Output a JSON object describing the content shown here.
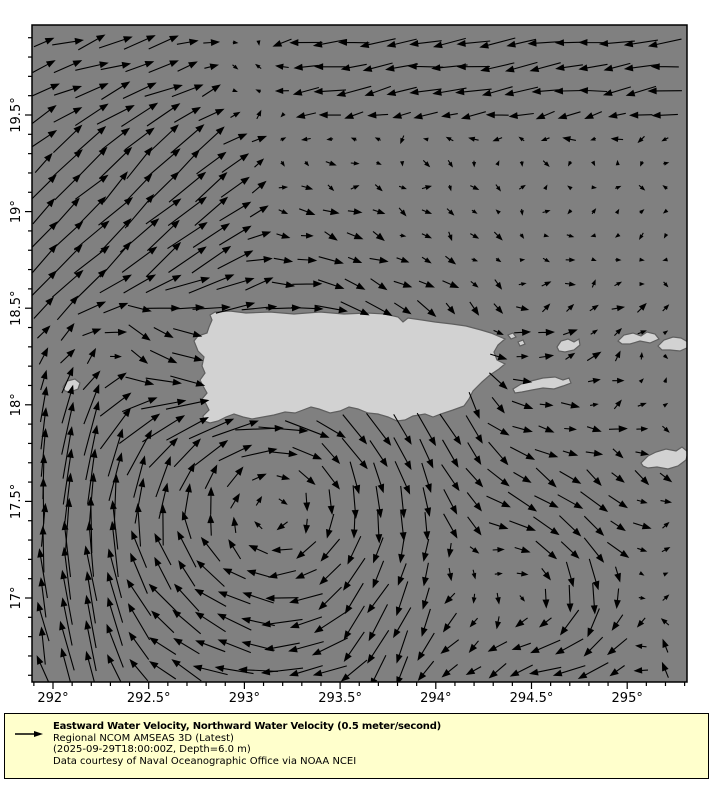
{
  "legend": {
    "title": "Eastward Water Velocity, Northward Water Velocity (0.5 meter/second)",
    "model": "Regional NCOM AMSEAS 3D (Latest)",
    "timestamp": "(2025-09-29T18:00:00Z, Depth=6.0 m)",
    "courtesy": "Data courtesy of Naval Oceanographic Office via NOAA NCEI",
    "symbol": "reference-arrow"
  },
  "colors": {
    "sea": "#808080",
    "land_fill": "#d2d2d2",
    "land_outline": "#5f5f5f",
    "arrow": "#000000",
    "legend_bg": "#ffffcc",
    "frame": "#000000",
    "page_bg": "#ffffff"
  },
  "axes": {
    "x": {
      "majors": [
        {
          "v": 292.0,
          "label": "292°"
        },
        {
          "v": 292.5,
          "label": "292.5°"
        },
        {
          "v": 293.0,
          "label": "293°"
        },
        {
          "v": 293.5,
          "label": "293.5°"
        },
        {
          "v": 294.0,
          "label": "294°"
        },
        {
          "v": 294.5,
          "label": "294.5°"
        },
        {
          "v": 295.0,
          "label": "295°"
        }
      ],
      "minor_step": 0.1
    },
    "y": {
      "majors": [
        {
          "v": 17.0,
          "label": "17°"
        },
        {
          "v": 17.5,
          "label": "17.5°"
        },
        {
          "v": 18.0,
          "label": "18°"
        },
        {
          "v": 18.5,
          "label": "18.5°"
        },
        {
          "v": 19.0,
          "label": "19°"
        },
        {
          "v": 19.5,
          "label": "19.5°"
        }
      ],
      "minor_step": 0.1
    }
  },
  "chart_data": {
    "type": "quiver_map",
    "lon_range": [
      291.885,
      295.315
    ],
    "lat_range": [
      16.565,
      19.965
    ],
    "reference_vector": {
      "speed": 0.5,
      "unit": "meter/second"
    },
    "projection": {
      "plot": {
        "left": 32,
        "top": 25,
        "width": 655,
        "height": 657
      },
      "lon_ref": 292.0,
      "x_ref": 53,
      "px_per_deg_lon": 191.4,
      "lat_ref": 19.5,
      "y_ref": 115,
      "px_per_deg_lat": 193.2
    },
    "grid": {
      "lon0": 291.95,
      "dlon": 0.125,
      "ncols": 28,
      "lat0": 16.625,
      "dlat": 0.125,
      "nrows": 27
    },
    "arrow_scale_px_per_mps": 95,
    "noise_amp": 0.055,
    "flow_features": {
      "vortices": [
        {
          "clon": 293.15,
          "clat": 17.45,
          "r": 1.0,
          "k": 0.45,
          "dir": "cw"
        },
        {
          "clon": 294.6,
          "clat": 17.0,
          "r": 0.55,
          "k": 0.33,
          "dir": "cw"
        }
      ],
      "bands": [
        {
          "box": [
            293.2,
            19.45,
            295.4,
            20.05
          ],
          "u": -0.32,
          "v": -0.04
        },
        {
          "box": [
            291.85,
            19.45,
            292.8,
            20.05
          ],
          "u": 0.3,
          "v": 0.1
        },
        {
          "box": [
            291.85,
            18.5,
            293.0,
            19.5
          ],
          "u": 0.25,
          "v": 0.26
        },
        {
          "box": [
            291.85,
            16.5,
            292.35,
            18.05
          ],
          "u": 0.02,
          "v": 0.3
        },
        {
          "box": [
            292.28,
            17.98,
            292.85,
            18.62
          ],
          "u": -0.06,
          "v": -0.3
        },
        {
          "box": [
            292.35,
            17.78,
            293.3,
            18.1
          ],
          "u": 0.28,
          "v": 0.02
        },
        {
          "box": [
            294.95,
            16.5,
            295.4,
            17.45
          ],
          "u": 0.02,
          "v": 0.28
        },
        {
          "box": [
            294.35,
            17.75,
            295.1,
            18.65
          ],
          "u": 0.07,
          "v": 0.1
        },
        {
          "box": [
            293.55,
            16.5,
            294.5,
            17.05
          ],
          "u": 0.13,
          "v": -0.17
        }
      ]
    },
    "islands_px": {
      "puerto_rico": [
        178,
        290,
        183,
        287,
        198,
        286,
        214,
        288,
        238,
        287,
        262,
        289,
        288,
        287,
        312,
        289,
        335,
        288,
        353,
        289,
        366,
        292,
        371,
        297,
        376,
        293,
        390,
        295,
        403,
        297,
        420,
        299,
        434,
        301,
        449,
        305,
        459,
        308,
        473,
        314,
        466,
        320,
        462,
        327,
        465,
        335,
        473,
        339,
        467,
        344,
        458,
        350,
        450,
        357,
        441,
        366,
        437,
        374,
        432,
        381,
        421,
        385,
        409,
        389,
        401,
        392,
        393,
        389,
        381,
        391,
        373,
        395,
        365,
        396,
        356,
        392,
        346,
        389,
        336,
        388,
        326,
        384,
        317,
        382,
        308,
        386,
        298,
        388,
        287,
        384,
        279,
        382,
        271,
        385,
        263,
        388,
        253,
        387,
        242,
        390,
        231,
        392,
        220,
        394,
        211,
        392,
        202,
        389,
        194,
        392,
        186,
        396,
        178,
        398,
        172,
        396,
        171,
        391,
        177,
        385,
        174,
        379,
        170,
        374,
        175,
        368,
        171,
        361,
        168,
        355,
        173,
        348,
        170,
        341,
        172,
        332,
        166,
        326,
        162,
        316,
        166,
        311,
        175,
        308,
        177,
        302,
        180,
        295
      ],
      "mona": [
        31,
        362,
        35,
        356,
        43,
        354,
        48,
        358,
        46,
        364,
        38,
        367,
        33,
        366
      ],
      "vieques": [
        481,
        364,
        489,
        359,
        499,
        356,
        511,
        353,
        523,
        352,
        531,
        355,
        537,
        353,
        539,
        358,
        531,
        361,
        522,
        364,
        511,
        363,
        500,
        365,
        490,
        367,
        483,
        368
      ],
      "culebra": [
        525,
        322,
        529,
        316,
        536,
        314,
        542,
        317,
        547,
        314,
        548,
        320,
        542,
        325,
        533,
        327,
        527,
        326
      ],
      "st_thomas_group": [
        586,
        316,
        592,
        310,
        601,
        308,
        609,
        311,
        615,
        307,
        623,
        309,
        627,
        314,
        618,
        318,
        608,
        316,
        598,
        319,
        590,
        319
      ],
      "tortola_group": [
        626,
        321,
        632,
        315,
        641,
        312,
        649,
        313,
        656,
        317,
        657,
        322,
        648,
        326,
        638,
        325,
        630,
        325
      ],
      "st_croix": [
        609,
        438,
        616,
        431,
        624,
        427,
        634,
        424,
        644,
        426,
        650,
        422,
        656,
        427,
        654,
        435,
        646,
        441,
        636,
        444,
        625,
        442,
        616,
        443,
        611,
        441
      ],
      "islet_ne_1": [
        476,
        310,
        481,
        308,
        484,
        312,
        479,
        314
      ],
      "islet_ne_2": [
        486,
        317,
        491,
        315,
        493,
        319,
        488,
        321
      ]
    }
  }
}
